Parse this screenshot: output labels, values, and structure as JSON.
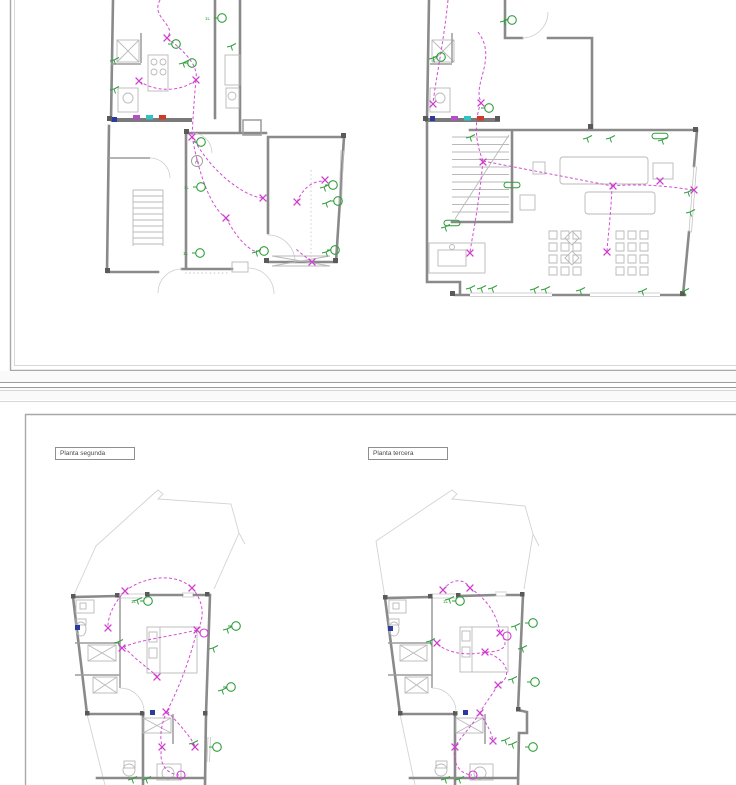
{
  "window": {
    "width": 736,
    "height": 785
  },
  "labels": {
    "bottom_left_plan": "Planta segunda",
    "bottom_right_plan": "Planta tercera",
    "room_marker": "A"
  },
  "colors": {
    "paper": "#ffffff",
    "wall_gray": "#8a8a8a",
    "furniture_gray": "#b9b9b9",
    "roof_gray": "#d3d3d3",
    "circuit_magenta": "#cf3ecf",
    "symbol_green": "#2f9e3b",
    "panel_magenta": "#b350c6",
    "panel_cyan": "#35c2c2",
    "panel_red": "#cf3b27",
    "panel_navy": "#2b3a9e",
    "separator_gray": "#9b9b9b",
    "frame_gray": "#a8a8a8"
  },
  "symbol_types": {
    "lt": "ceiling-light-icon",
    "sw": "switch-icon",
    "x": "circuit-node-cross-icon",
    "mc": "wall-light-icon",
    "pl": "fluorescent-light-icon",
    "pn": "panel-module-icon",
    "bb": "junction-box-icon"
  },
  "plans": {
    "tl": {
      "symbols": [
        {
          "t": "pn",
          "x": 133,
          "y": 115,
          "c": "#b350c6"
        },
        {
          "t": "pn",
          "x": 146,
          "y": 115,
          "c": "#35c2c2"
        },
        {
          "t": "pn",
          "x": 159,
          "y": 115,
          "c": "#cf3b27"
        },
        {
          "t": "bb",
          "x": 112,
          "y": 117
        },
        {
          "t": "lt",
          "x": 176,
          "y": 44
        },
        {
          "t": "lt",
          "x": 192,
          "y": 63
        },
        {
          "t": "lt",
          "x": 222,
          "y": 18,
          "l": "1L"
        },
        {
          "t": "lt",
          "x": 201,
          "y": 142
        },
        {
          "t": "lt",
          "x": 201,
          "y": 187,
          "l": "1L"
        },
        {
          "t": "lt",
          "x": 200,
          "y": 253,
          "l": "1L"
        },
        {
          "t": "lt",
          "x": 264,
          "y": 251
        },
        {
          "t": "lt",
          "x": 333,
          "y": 185
        },
        {
          "t": "lt",
          "x": 338,
          "y": 201
        },
        {
          "t": "lt",
          "x": 335,
          "y": 250
        },
        {
          "t": "sw",
          "x": 114,
          "y": 60
        },
        {
          "t": "sw",
          "x": 114,
          "y": 89
        },
        {
          "t": "sw",
          "x": 183,
          "y": 63
        },
        {
          "t": "sw",
          "x": 231,
          "y": 46
        },
        {
          "t": "sw",
          "x": 256,
          "y": 252
        },
        {
          "t": "sw",
          "x": 324,
          "y": 187
        },
        {
          "t": "sw",
          "x": 326,
          "y": 203
        },
        {
          "t": "sw",
          "x": 326,
          "y": 252
        },
        {
          "t": "x",
          "x": 167,
          "y": 38
        },
        {
          "t": "x",
          "x": 196,
          "y": 80
        },
        {
          "t": "x",
          "x": 139,
          "y": 81
        },
        {
          "t": "x",
          "x": 192,
          "y": 137
        },
        {
          "t": "x",
          "x": 263,
          "y": 198
        },
        {
          "t": "x",
          "x": 226,
          "y": 218
        },
        {
          "t": "x",
          "x": 297,
          "y": 202
        },
        {
          "t": "x",
          "x": 325,
          "y": 180
        },
        {
          "t": "x",
          "x": 312,
          "y": 262
        }
      ]
    },
    "tr": {
      "symbols": [
        {
          "t": "pn",
          "x": 451,
          "y": 116,
          "c": "#b350c6"
        },
        {
          "t": "pn",
          "x": 464,
          "y": 116,
          "c": "#35c2c2"
        },
        {
          "t": "pn",
          "x": 477,
          "y": 116,
          "c": "#cf3b27"
        },
        {
          "t": "bb",
          "x": 430,
          "y": 116
        },
        {
          "t": "lt",
          "x": 489,
          "y": 108
        },
        {
          "t": "lt",
          "x": 441,
          "y": 57
        },
        {
          "t": "lt",
          "x": 512,
          "y": 20
        },
        {
          "t": "pl",
          "x": 512,
          "y": 185
        },
        {
          "t": "pl",
          "x": 452,
          "y": 223
        },
        {
          "t": "pl",
          "x": 660,
          "y": 136
        },
        {
          "t": "sw",
          "x": 433,
          "y": 58
        },
        {
          "t": "sw",
          "x": 504,
          "y": 21
        },
        {
          "t": "sw",
          "x": 470,
          "y": 137
        },
        {
          "t": "sw",
          "x": 587,
          "y": 138
        },
        {
          "t": "sw",
          "x": 610,
          "y": 138
        },
        {
          "t": "sw",
          "x": 662,
          "y": 140
        },
        {
          "t": "sw",
          "x": 470,
          "y": 288
        },
        {
          "t": "sw",
          "x": 481,
          "y": 288
        },
        {
          "t": "sw",
          "x": 492,
          "y": 288
        },
        {
          "t": "sw",
          "x": 534,
          "y": 289
        },
        {
          "t": "sw",
          "x": 545,
          "y": 289
        },
        {
          "t": "sw",
          "x": 580,
          "y": 290
        },
        {
          "t": "sw",
          "x": 642,
          "y": 291
        },
        {
          "t": "sw",
          "x": 684,
          "y": 291
        },
        {
          "t": "sw",
          "x": 688,
          "y": 192
        },
        {
          "t": "sw",
          "x": 690,
          "y": 212
        },
        {
          "t": "sw",
          "x": 445,
          "y": 227
        },
        {
          "t": "x",
          "x": 433,
          "y": 104
        },
        {
          "t": "x",
          "x": 481,
          "y": 103
        },
        {
          "t": "x",
          "x": 483,
          "y": 162
        },
        {
          "t": "x",
          "x": 613,
          "y": 186
        },
        {
          "t": "x",
          "x": 607,
          "y": 252
        },
        {
          "t": "x",
          "x": 470,
          "y": 253
        },
        {
          "t": "x",
          "x": 660,
          "y": 181
        },
        {
          "t": "x",
          "x": 694,
          "y": 190
        }
      ]
    },
    "bl": {
      "symbols": [
        {
          "t": "bb",
          "x": 75,
          "y": 625
        },
        {
          "t": "bb",
          "x": 150,
          "y": 710
        },
        {
          "t": "lt",
          "x": 148,
          "y": 601,
          "l": "1L"
        },
        {
          "t": "lt",
          "x": 236,
          "y": 626
        },
        {
          "t": "lt",
          "x": 231,
          "y": 687
        },
        {
          "t": "lt",
          "x": 217,
          "y": 747
        },
        {
          "t": "sw",
          "x": 137,
          "y": 600
        },
        {
          "t": "sw",
          "x": 222,
          "y": 690
        },
        {
          "t": "sw",
          "x": 213,
          "y": 648
        },
        {
          "t": "sw",
          "x": 118,
          "y": 642
        },
        {
          "t": "sw",
          "x": 193,
          "y": 743
        },
        {
          "t": "sw",
          "x": 132,
          "y": 779
        },
        {
          "t": "sw",
          "x": 146,
          "y": 779
        },
        {
          "t": "sw",
          "x": 227,
          "y": 629
        },
        {
          "t": "x",
          "x": 125,
          "y": 591
        },
        {
          "t": "x",
          "x": 192,
          "y": 588
        },
        {
          "t": "x",
          "x": 197,
          "y": 630
        },
        {
          "t": "x",
          "x": 122,
          "y": 648
        },
        {
          "t": "x",
          "x": 157,
          "y": 677
        },
        {
          "t": "x",
          "x": 166,
          "y": 712
        },
        {
          "t": "x",
          "x": 162,
          "y": 747
        },
        {
          "t": "x",
          "x": 195,
          "y": 747
        },
        {
          "t": "x",
          "x": 108,
          "y": 628
        },
        {
          "t": "mc",
          "x": 181,
          "y": 775
        },
        {
          "t": "mc",
          "x": 204,
          "y": 633
        }
      ]
    },
    "br": {
      "symbols": [
        {
          "t": "bb",
          "x": 388,
          "y": 626
        },
        {
          "t": "bb",
          "x": 463,
          "y": 710
        },
        {
          "t": "lt",
          "x": 460,
          "y": 601,
          "l": "1L"
        },
        {
          "t": "lt",
          "x": 533,
          "y": 623
        },
        {
          "t": "lt",
          "x": 535,
          "y": 682
        },
        {
          "t": "lt",
          "x": 533,
          "y": 747
        },
        {
          "t": "sw",
          "x": 449,
          "y": 599
        },
        {
          "t": "sw",
          "x": 515,
          "y": 626
        },
        {
          "t": "sw",
          "x": 512,
          "y": 679
        },
        {
          "t": "sw",
          "x": 512,
          "y": 744
        },
        {
          "t": "sw",
          "x": 522,
          "y": 648
        },
        {
          "t": "sw",
          "x": 430,
          "y": 641
        },
        {
          "t": "sw",
          "x": 505,
          "y": 740
        },
        {
          "t": "sw",
          "x": 445,
          "y": 779
        },
        {
          "t": "sw",
          "x": 459,
          "y": 779
        },
        {
          "t": "x",
          "x": 443,
          "y": 590
        },
        {
          "t": "x",
          "x": 470,
          "y": 588
        },
        {
          "t": "x",
          "x": 500,
          "y": 633
        },
        {
          "t": "x",
          "x": 485,
          "y": 652
        },
        {
          "t": "x",
          "x": 498,
          "y": 685
        },
        {
          "t": "x",
          "x": 480,
          "y": 713
        },
        {
          "t": "x",
          "x": 455,
          "y": 747
        },
        {
          "t": "x",
          "x": 493,
          "y": 741
        },
        {
          "t": "x",
          "x": 437,
          "y": 643
        },
        {
          "t": "mc",
          "x": 473,
          "y": 775
        },
        {
          "t": "mc",
          "x": 507,
          "y": 636
        }
      ]
    }
  }
}
